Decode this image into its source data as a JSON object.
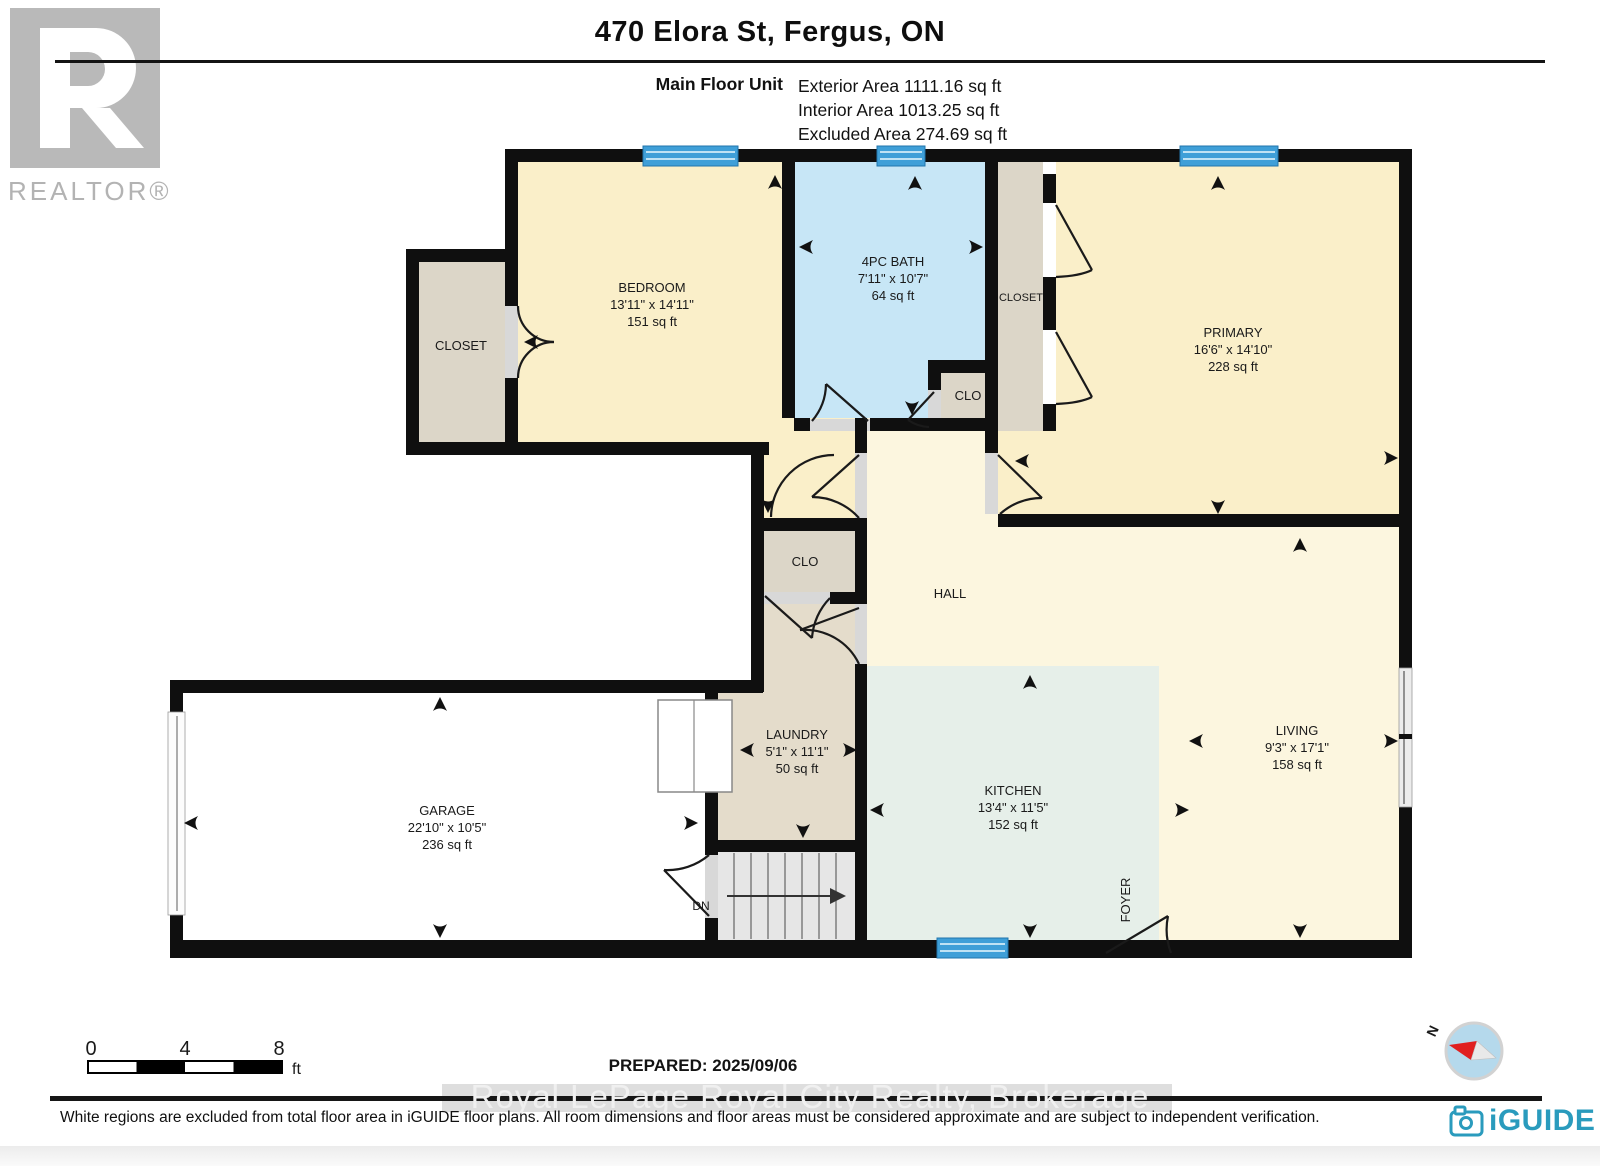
{
  "header": {
    "logo": {
      "brand": "REALTOR®"
    },
    "title": "470 Elora St, Fergus, ON",
    "unit_label": "Main Floor Unit",
    "stats": {
      "exterior": "Exterior Area 1111.16 sq ft",
      "interior": "Interior Area 1013.25 sq ft",
      "excluded": "Excluded Area 274.69 sq ft"
    }
  },
  "plan": {
    "rooms": {
      "bedroom": {
        "name": "BEDROOM",
        "dims": "13'11\" x 14'11\"",
        "area": "151 sq ft"
      },
      "closet_bedroom": {
        "name": "CLOSET"
      },
      "bath": {
        "name": "4PC BATH",
        "dims": "7'11\" x 10'7\"",
        "area": "64 sq ft"
      },
      "clo_bath": {
        "name": "CLO"
      },
      "closet_primary": {
        "name": "CLOSET"
      },
      "primary": {
        "name": "PRIMARY",
        "dims": "16'6\" x 14'10\"",
        "area": "228 sq ft"
      },
      "hall": {
        "name": "HALL"
      },
      "clo_hall": {
        "name": "CLO"
      },
      "laundry": {
        "name": "LAUNDRY",
        "dims": "5'1\" x 11'1\"",
        "area": "50 sq ft"
      },
      "garage": {
        "name": "GARAGE",
        "dims": "22'10\" x 10'5\"",
        "area": "236 sq ft"
      },
      "kitchen": {
        "name": "KITCHEN",
        "dims": "13'4\" x 11'5\"",
        "area": "152 sq ft"
      },
      "living": {
        "name": "LIVING",
        "dims": "9'3\" x 17'1\"",
        "area": "158 sq ft"
      },
      "foyer": {
        "name": "FOYER"
      }
    },
    "stairs_label": "DN",
    "colors": {
      "wall": "#0f0f0f",
      "room_yellow": "#faefc9",
      "room_cream": "#fcf6df",
      "bath_blue": "#c7e6f6",
      "closet_beige": "#dcd6c8",
      "laundry_beige": "#e4dccb",
      "kitchen_green": "#e6efe9",
      "window_blue": "#3f9fd8",
      "compass_red": "#e02020"
    }
  },
  "footer": {
    "scale": {
      "t0": "0",
      "t4": "4",
      "t8": "8",
      "unit": "ft"
    },
    "prepared": "PREPARED: 2025/09/06",
    "watermark": "Royal LePage Royal City Realty, Brokerage",
    "disclaimer": "White regions are excluded from total floor area in iGUIDE floor plans. All room dimensions and floor areas must be considered approximate and are subject to independent verification.",
    "brand": "iGUIDE",
    "compass_n": "N"
  }
}
